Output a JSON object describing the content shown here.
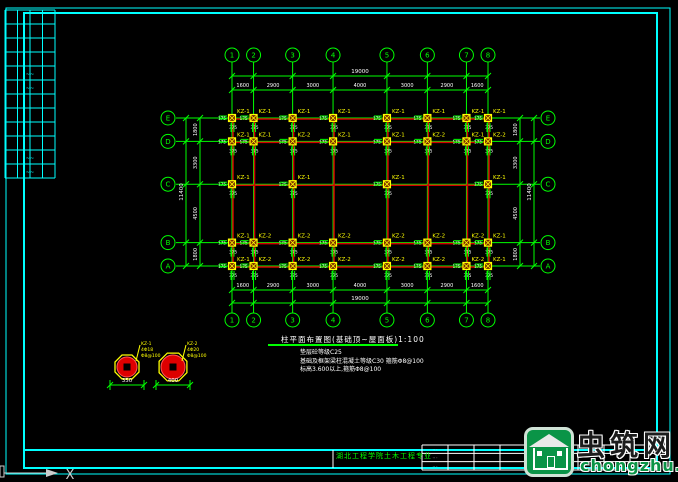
{
  "colors": {
    "background": "#000000",
    "frame_cyan": "#00ffff",
    "axis_green": "#00ff00",
    "beam_red": "#d40000",
    "column_yellow": "#ffff00",
    "text_white": "#ffffff",
    "watermark_green": "#0a9447"
  },
  "plan": {
    "title": "柱平面布置图(基础顶~屋面板)1:100",
    "notes": [
      "垫层砼等级C25",
      "基础及框架梁柱混凝土等级C30 箍筋Φ8@100",
      "标高3.600以上,箍筋Φ8@100"
    ],
    "number_axes": {
      "labels": [
        "1",
        "2",
        "3",
        "4",
        "5",
        "6",
        "7",
        "8"
      ],
      "spacings": [
        "1600",
        "2900",
        "3000",
        "4000",
        "3000",
        "2900",
        "1600"
      ],
      "total": "19000"
    },
    "letter_axes": {
      "labels": [
        "E",
        "D",
        "C",
        "B",
        "A"
      ],
      "spacings": [
        "1800",
        "3300",
        "4500",
        "1800"
      ],
      "total": "11400"
    },
    "columns": {
      "micro_dims": [
        "175",
        "375"
      ],
      "rows": [
        {
          "row": "E",
          "axes": [
            1,
            2,
            3,
            4,
            5,
            6,
            7,
            8
          ],
          "kz": [
            "KZ-1",
            "KZ-1",
            "KZ-1",
            "KZ-1",
            "KZ-1",
            "KZ-1",
            "KZ-1",
            "KZ-1"
          ]
        },
        {
          "row": "D",
          "axes": [
            1,
            2,
            3,
            4,
            5,
            6,
            7,
            8
          ],
          "kz": [
            "KZ-1",
            "KZ-1",
            "KZ-2",
            "KZ-1",
            "KZ-1",
            "KZ-2",
            "KZ-1",
            "KZ-2"
          ]
        },
        {
          "row": "C",
          "axes": [
            1,
            3,
            5,
            8
          ],
          "kz": [
            "KZ-1",
            "KZ-1",
            "KZ-1",
            "KZ-1"
          ]
        },
        {
          "row": "B",
          "axes": [
            1,
            2,
            3,
            4,
            5,
            6,
            7,
            8
          ],
          "kz": [
            "KZ-1",
            "KZ-2",
            "KZ-2",
            "KZ-2",
            "KZ-2",
            "KZ-2",
            "KZ-2",
            "KZ-1"
          ]
        },
        {
          "row": "A",
          "axes": [
            1,
            2,
            3,
            4,
            5,
            6,
            7,
            8
          ],
          "kz": [
            "KZ-1",
            "KZ-2",
            "KZ-2",
            "KZ-2",
            "KZ-2",
            "KZ-2",
            "KZ-2",
            "KZ-1"
          ]
        }
      ]
    }
  },
  "details": [
    {
      "size_label": "350",
      "leader": [
        "KZ-1",
        "4Φ18",
        "Φ8@100"
      ]
    },
    {
      "size_label": "400",
      "leader": [
        "KZ-2",
        "4Φ20",
        "Φ8@100"
      ]
    }
  ],
  "footer": {
    "department": "湖北工程学院土木工程专业"
  },
  "ucs": {
    "axis_label": "X"
  },
  "title_block": {
    "rows": 3,
    "cols": 9,
    "mark_text": "·· ·",
    "marked_cells": [
      [
        0,
        0
      ],
      [
        0,
        4
      ],
      [
        0,
        7
      ],
      [
        1,
        0
      ],
      [
        1,
        4
      ],
      [
        2,
        0
      ],
      [
        2,
        4
      ],
      [
        2,
        7
      ]
    ]
  },
  "left_strip": {
    "cols": 4,
    "rows": 12,
    "mark_text": "~~",
    "mark_rows": [
      4,
      5,
      10,
      11
    ]
  },
  "watermark": {
    "site_name": "虫筑网",
    "site_url": "chongzhu.cn"
  }
}
